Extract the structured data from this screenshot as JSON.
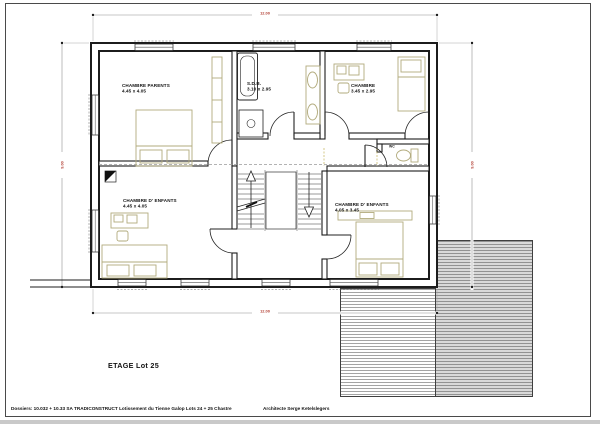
{
  "sheet": {
    "title": "ETAGE  Lot 25",
    "footer": {
      "dossier": "Dossiers: 10.032 + 10.33 SA TRADICONSTRUCT   Lotissement du Tienne Galop   Lots 24 + 25    Chastre",
      "architect": "Architecte Serge Ketelslegers"
    }
  },
  "rooms": {
    "parents": {
      "name": "CHAMBRE PARENTS",
      "size": "4.45 x 4.05"
    },
    "bathroom": {
      "name": "S.D.B.",
      "size": "3.10 x 2.95"
    },
    "bedroom_ne": {
      "name": "CHAMBRE",
      "size": "3.45 x 2.95"
    },
    "wc": {
      "name": "WC"
    },
    "kids_left": {
      "name": "CHAMBRE D' ENFANTS",
      "size": "4.45 x 4.05"
    },
    "kids_right": {
      "name": "CHAMBRE D' ENFANTS",
      "size": "4.05 x 3.45"
    }
  },
  "dimensions": {
    "top": "12.00",
    "bottom": "12.00",
    "left": "9.00",
    "right": "9.00"
  },
  "colors": {
    "wall": "#1c1c1c",
    "furniture": "#b2ab7d",
    "dimension_text": "#b03a2e",
    "hatch_fill": "#d9d9d9"
  }
}
